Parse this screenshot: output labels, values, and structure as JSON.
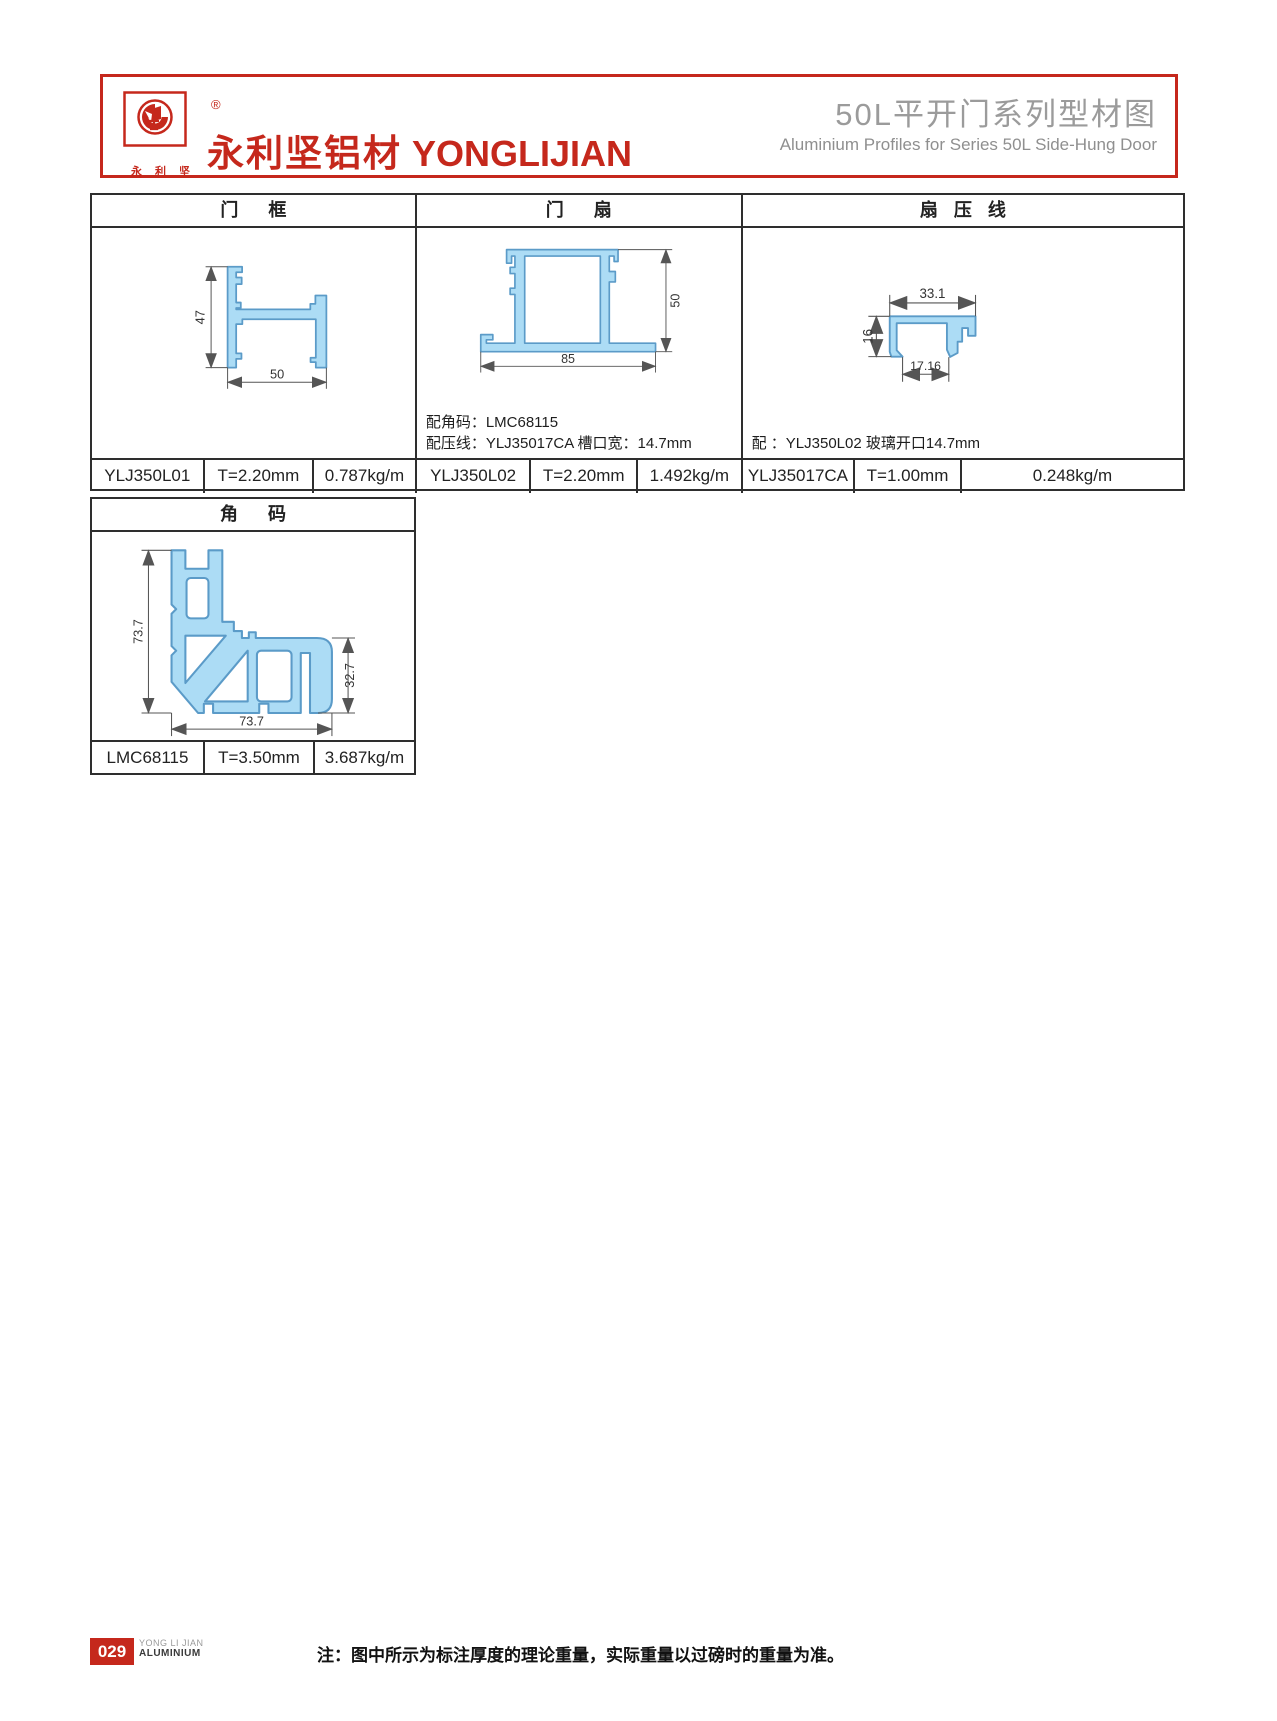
{
  "header": {
    "registered": "®",
    "logo_chars": "永利坚",
    "company_cn": "永利坚铝材",
    "company_en": "YONGLIJIAN",
    "title_cn": "50L平开门系列型材图",
    "title_en": "Aluminium Profiles for Series 50L Side-Hung Door"
  },
  "sections": {
    "frame": {
      "title": "门框",
      "code": "YLJ350L01",
      "thickness": "T=2.20mm",
      "weight": "0.787kg/m",
      "dim_height": "47",
      "dim_width": "50"
    },
    "sash": {
      "title": "门扇",
      "code": "YLJ350L02",
      "thickness": "T=2.20mm",
      "weight": "1.492kg/m",
      "dim_width": "85",
      "dim_height": "50",
      "note1": "配角码：LMC68115",
      "note2": "配压线：YLJ35017CA 槽口宽：14.7mm"
    },
    "bead": {
      "title": "扇压线",
      "code": "YLJ35017CA",
      "thickness": "T=1.00mm",
      "weight": "0.248kg/m",
      "dim_top": "33.1",
      "dim_left": "16",
      "dim_bottom": "17.16",
      "note1": "配 ：YLJ350L02 玻璃开口14.7mm"
    },
    "corner": {
      "title": "角码",
      "code": "LMC68115",
      "thickness": "T=3.50mm",
      "weight": "3.687kg/m",
      "dim_left": "73.7",
      "dim_bottom": "73.7",
      "dim_right": "32.7"
    }
  },
  "footer": {
    "page_no": "029",
    "brand_top": "YONG LI JIAN",
    "brand_bottom": "ALUMINIUM",
    "note": "注：图中所示为标注厚度的理论重量，实际重量以过磅时的重量为准。"
  },
  "colors": {
    "accent": "#C5281C",
    "profile_fill": "#ACDCF5",
    "profile_stroke": "#5B9BC8",
    "table_line": "#2E2E2E",
    "dim_line": "#555555"
  }
}
